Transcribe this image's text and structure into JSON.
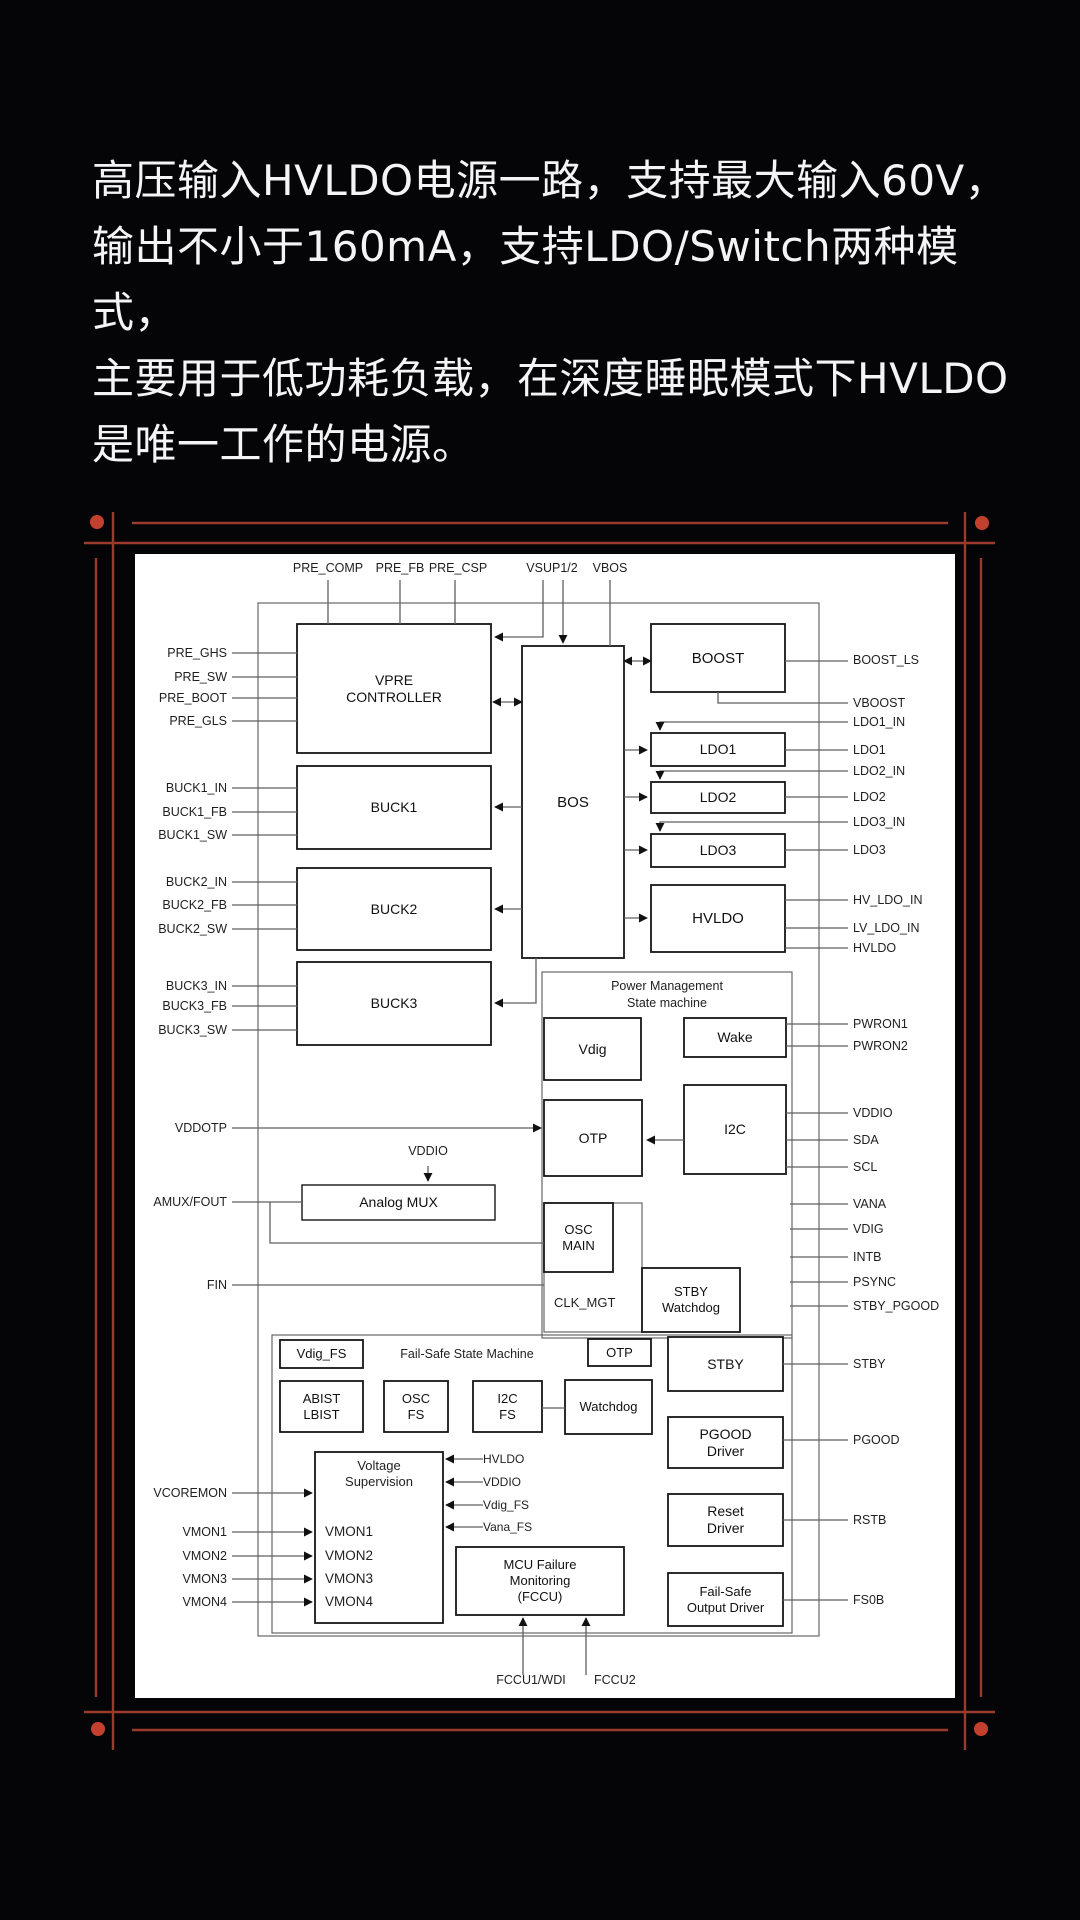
{
  "intro": {
    "lines": [
      "高压输入HVLDO电源一路，支持最大输入60V，",
      "输出不小于160mA，支持LDO/Switch两种模式，",
      "主要用于低功耗负载，在深度睡眠模式下HVLDO",
      "是唯一工作的电源。"
    ]
  },
  "diagram": {
    "top_pins": [
      "PRE_COMP",
      "PRE_FB",
      "PRE_CSP",
      "VSUP1/2",
      "VBOS"
    ],
    "left_pins": [
      "PRE_GHS",
      "PRE_SW",
      "PRE_BOOT",
      "PRE_GLS",
      "BUCK1_IN",
      "BUCK1_FB",
      "BUCK1_SW",
      "BUCK2_IN",
      "BUCK2_FB",
      "BUCK2_SW",
      "BUCK3_IN",
      "BUCK3_FB",
      "BUCK3_SW",
      "VDDOTP",
      "AMUX/FOUT",
      "FIN",
      "VCOREMON",
      "VMON1",
      "VMON2",
      "VMON3",
      "VMON4"
    ],
    "right_pins": [
      "BOOST_LS",
      "VBOOST",
      "LDO1_IN",
      "LDO1",
      "LDO2_IN",
      "LDO2",
      "LDO3_IN",
      "LDO3",
      "HV_LDO_IN",
      "LV_LDO_IN",
      "HVLDO",
      "PWRON1",
      "PWRON2",
      "VDDIO",
      "SDA",
      "SCL",
      "VANA",
      "VDIG",
      "INTB",
      "PSYNC",
      "STBY_PGOOD",
      "STBY",
      "PGOOD",
      "RSTB",
      "FS0B"
    ],
    "blocks": {
      "vpre": "VPRE\nCONTROLLER",
      "buck1": "BUCK1",
      "buck2": "BUCK2",
      "buck3": "BUCK3",
      "bos": "BOS",
      "boost": "BOOST",
      "ldo1": "LDO1",
      "ldo2": "LDO2",
      "ldo3": "LDO3",
      "hvldo": "HVLDO",
      "pm_title": "Power Management\nState machine",
      "vdig": "Vdig",
      "wake": "Wake",
      "otp": "OTP",
      "i2c": "I2C",
      "osc_main": "OSC\nMAIN",
      "clk_mgt": "CLK_MGT",
      "stby_watchdog": "STBY\nWatchdog",
      "analog_mux": "Analog MUX",
      "vddio_feed": "VDDIO",
      "fs_vdig": "Vdig_FS",
      "fs_title": "Fail-Safe State Machine",
      "fs_otp": "OTP",
      "abist": "ABIST\nLBIST",
      "osc_fs": "OSC\nFS",
      "i2c_fs": "I2C\nFS",
      "watchdog": "Watchdog",
      "voltage_supervision": "Voltage\nSupervision",
      "vmon_list": [
        "VMON1",
        "VMON2",
        "VMON3",
        "VMON4"
      ],
      "vs_inputs": [
        "HVLDO",
        "VDDIO",
        "Vdig_FS",
        "Vana_FS"
      ],
      "mcu": "MCU Failure\nMonitoring\n(FCCU)",
      "stby": "STBY",
      "pgood_driver": "PGOOD\nDriver",
      "reset_driver": "Reset\nDriver",
      "failsafe_output": "Fail-Safe\nOutput Driver",
      "fccu1": "FCCU1/WDI",
      "fccu2": "FCCU2"
    },
    "colors": {
      "background": "#050508",
      "panel": "#ffffff",
      "accent_line": "#9c3a2b",
      "accent_dot": "#c4402e",
      "wire": "#5f5f5f",
      "block_border": "#161616"
    }
  }
}
